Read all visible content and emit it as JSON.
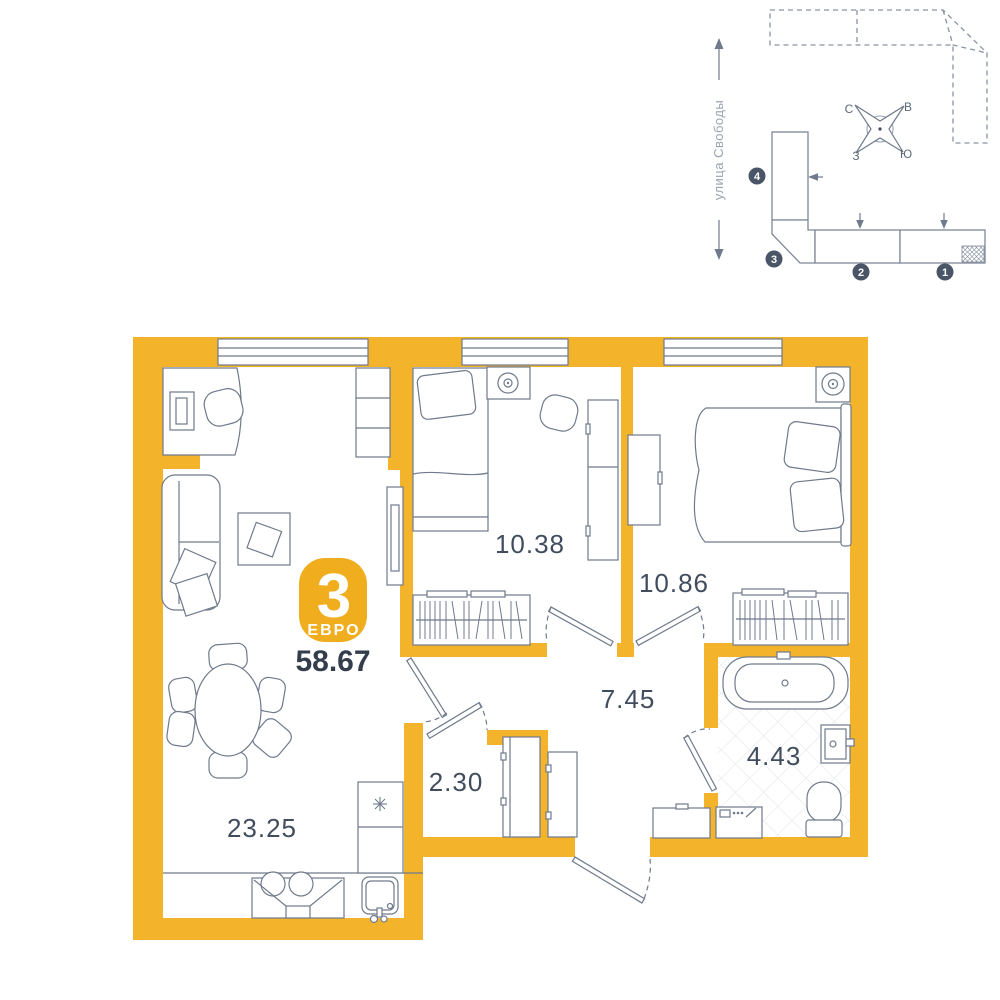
{
  "plan": {
    "badge": {
      "rooms_count": "3",
      "type_label": "ЕВРО",
      "total_area": "58.67"
    },
    "rooms": [
      {
        "id": "living-kitchen",
        "area": "23.25"
      },
      {
        "id": "bedroom-small",
        "area": "10.38"
      },
      {
        "id": "bedroom-large",
        "area": "10.86"
      },
      {
        "id": "hallway",
        "area": "7.45"
      },
      {
        "id": "closet",
        "area": "2.30"
      },
      {
        "id": "bathroom",
        "area": "4.43"
      }
    ]
  },
  "minimap": {
    "street_label": "улица Свободы",
    "compass": {
      "north": "С",
      "east": "В",
      "west": "З",
      "south": "Ю"
    },
    "sections": [
      {
        "number": "1"
      },
      {
        "number": "2"
      },
      {
        "number": "3"
      },
      {
        "number": "4"
      }
    ]
  },
  "colors": {
    "wall_accent": "#F3B32B",
    "badge_accent": "#F0AD1E",
    "plan_line": "#6F7A8B",
    "label_text": "#414D5E",
    "total_text": "#333D4B",
    "minimap_badge": "#4A5568",
    "tile_line": "#DFE3E8"
  }
}
